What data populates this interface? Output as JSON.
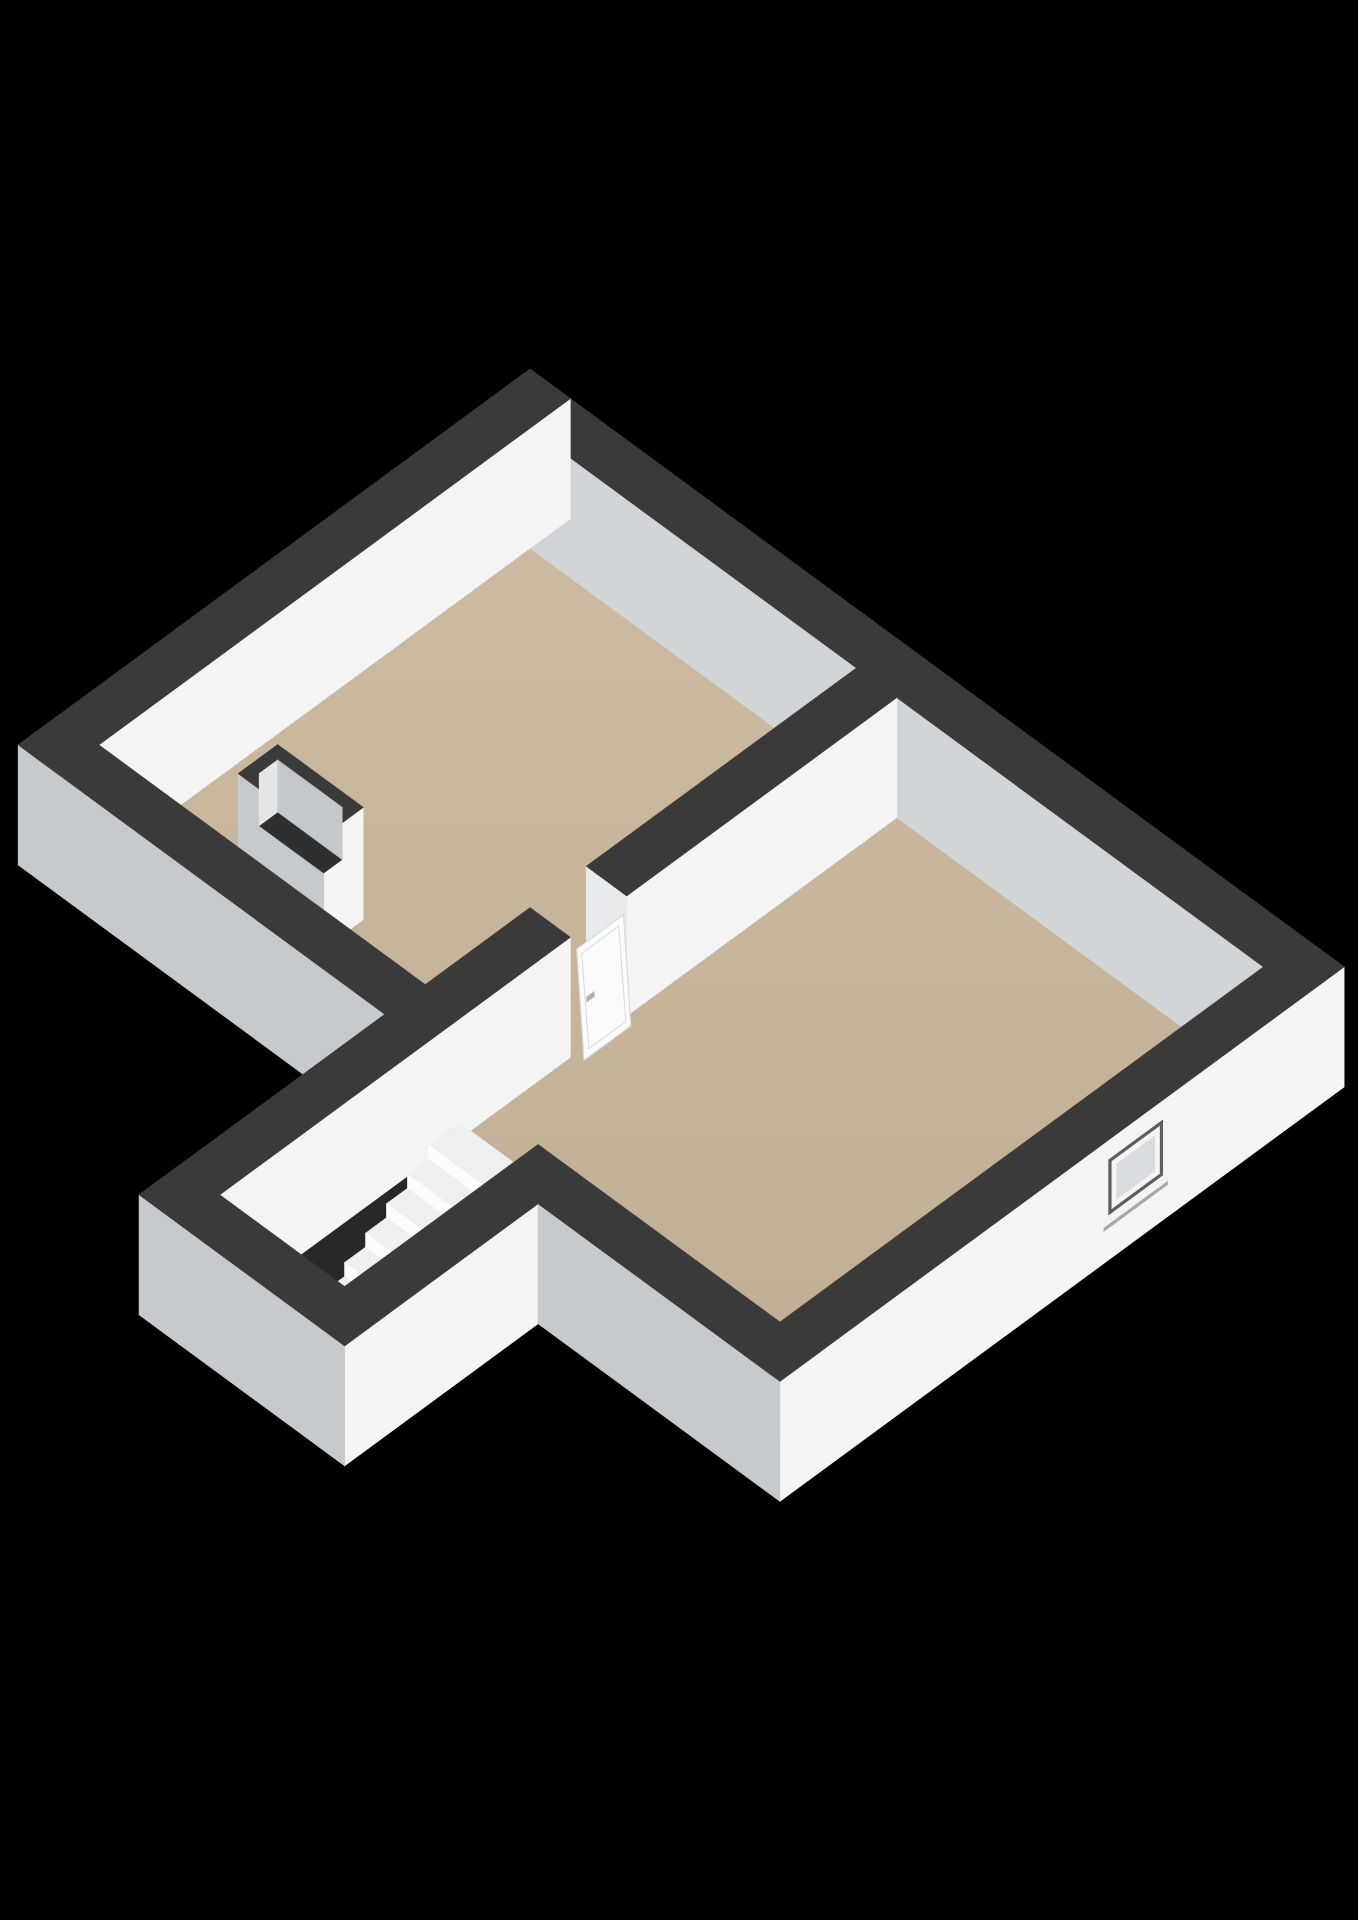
{
  "scene": {
    "background": "#000000",
    "canvas": {
      "w": 1358,
      "h": 1920
    },
    "projection": {
      "ox": 530,
      "oy": 369,
      "k": 0.806,
      "d": 0.592,
      "wall_h": 120
    },
    "palette": {
      "wall_top": "#3a3a3b",
      "face_se": "#f4f4f5",
      "face_outer_sw": "#c7cacc",
      "face_inner_sw": "#d2d5d7",
      "face_end": "#e9eaeb",
      "void": "#26282a",
      "door": "#fbfbfb",
      "door_edge": "#d8dadb",
      "handle": "#aeb1b3",
      "stair_riser": "#fcfcfd",
      "stair_tread": "#edeff0",
      "stair_side": "#e7e9eb",
      "stair_slab": "#f3f4f5",
      "chimney_inner_a": "#e3e5e6",
      "chimney_inner_b": "#c5c8ca",
      "chimney_hole": "#2d2f30",
      "window_reveal": "#5b5e60",
      "window_frame": "#f4f4f4",
      "window_glass": "#dadde0",
      "window_sill": "#f2f3f4",
      "window_sill_shadow": "#a6a9ab"
    },
    "floor_gradient": {
      "from": "#cdbca2",
      "to": "#bfae94",
      "y1": 420,
      "y2": 1480
    },
    "elements": [
      {
        "type": "floor",
        "name": "floor-room-a",
        "pts": [
          [
            50,
            50
          ],
          [
            455,
            50
          ],
          [
            455,
            585
          ],
          [
            50,
            585
          ]
        ]
      },
      {
        "type": "floor",
        "name": "floor-room-b-hall",
        "pts": [
          [
            505,
            50
          ],
          [
            960,
            50
          ],
          [
            960,
            650
          ],
          [
            660,
            650
          ],
          [
            660,
            890
          ],
          [
            505,
            890
          ],
          [
            505,
            455
          ],
          [
            455,
            455
          ],
          [
            455,
            385
          ],
          [
            505,
            385
          ]
        ]
      },
      {
        "type": "wall",
        "name": "wall-north-east",
        "u1": 0,
        "u2": 1010,
        "v1": 0,
        "v2": 50,
        "faces": {
          "sw": "face_inner_sw",
          "top": "wall_top"
        }
      },
      {
        "type": "wall",
        "name": "wall-north-west",
        "u1": 0,
        "u2": 50,
        "v1": 0,
        "v2": 635,
        "faces": {
          "se": "face_se",
          "top": "wall_top"
        }
      },
      {
        "type": "wall",
        "name": "wall-partition",
        "u1": 455,
        "u2": 505,
        "v1": 50,
        "v2": 385,
        "faces": {
          "se": "face_se",
          "sw": "face_end",
          "top": "wall_top"
        }
      },
      {
        "type": "chimney",
        "name": "chimney-shaft",
        "u1": 154,
        "u2": 260,
        "v1": 467,
        "v2": 516,
        "h": 112,
        "rim": 13,
        "drop": 52
      },
      {
        "type": "door",
        "name": "interior-door",
        "u_top": 507,
        "u_bottom": 516,
        "v1": 391,
        "v2": 449,
        "h": 106,
        "handle_v": 441,
        "handle_z": 53
      },
      {
        "type": "wall",
        "name": "wall-room-a-south-west",
        "u1": 0,
        "u2": 505,
        "v1": 585,
        "v2": 635,
        "faces": {
          "se": "face_se",
          "sw": "face_outer_sw",
          "top": "wall_top"
        }
      },
      {
        "type": "wall",
        "name": "wall-stair-north-west",
        "u1": 455,
        "u2": 505,
        "v1": 455,
        "v2": 940,
        "faces": {
          "se": "face_se",
          "top": "wall_top"
        }
      },
      {
        "type": "void",
        "name": "stairwell-void",
        "pts": [
          [
            505,
            650
          ],
          [
            562,
            650
          ],
          [
            562,
            880
          ],
          [
            505,
            880
          ]
        ]
      },
      {
        "type": "stairs",
        "name": "staircase",
        "u1": 562,
        "u2": 645,
        "v_edges": [
          650,
          688,
          714,
          740,
          766,
          792,
          818,
          888
        ],
        "z_levels": [
          84,
          70,
          56,
          42,
          28,
          14,
          2
        ]
      },
      {
        "type": "wall",
        "name": "wall-wing-south-east",
        "u1": 660,
        "u2": 710,
        "v1": 650,
        "v2": 940,
        "faces": {
          "se": "face_se",
          "top": "wall_top"
        }
      },
      {
        "type": "wall",
        "name": "wall-room-b-south-east",
        "u1": 960,
        "u2": 1010,
        "v1": 0,
        "v2": 700,
        "faces": {
          "se": "face_se",
          "top": "wall_top"
        }
      },
      {
        "type": "window",
        "name": "exterior-window",
        "wall_u": 1010,
        "v1": 225,
        "v2": 292,
        "z1": 45,
        "z2": 100
      },
      {
        "type": "wall",
        "name": "wall-room-b-south-west",
        "u1": 710,
        "u2": 1010,
        "v1": 650,
        "v2": 700,
        "faces": {
          "sw": "face_outer_sw",
          "top": "wall_top"
        }
      },
      {
        "type": "wall",
        "name": "wall-wing-end",
        "u1": 455,
        "u2": 710,
        "v1": 890,
        "v2": 940,
        "faces": {
          "sw": "face_outer_sw",
          "top": "wall_top"
        }
      }
    ]
  }
}
